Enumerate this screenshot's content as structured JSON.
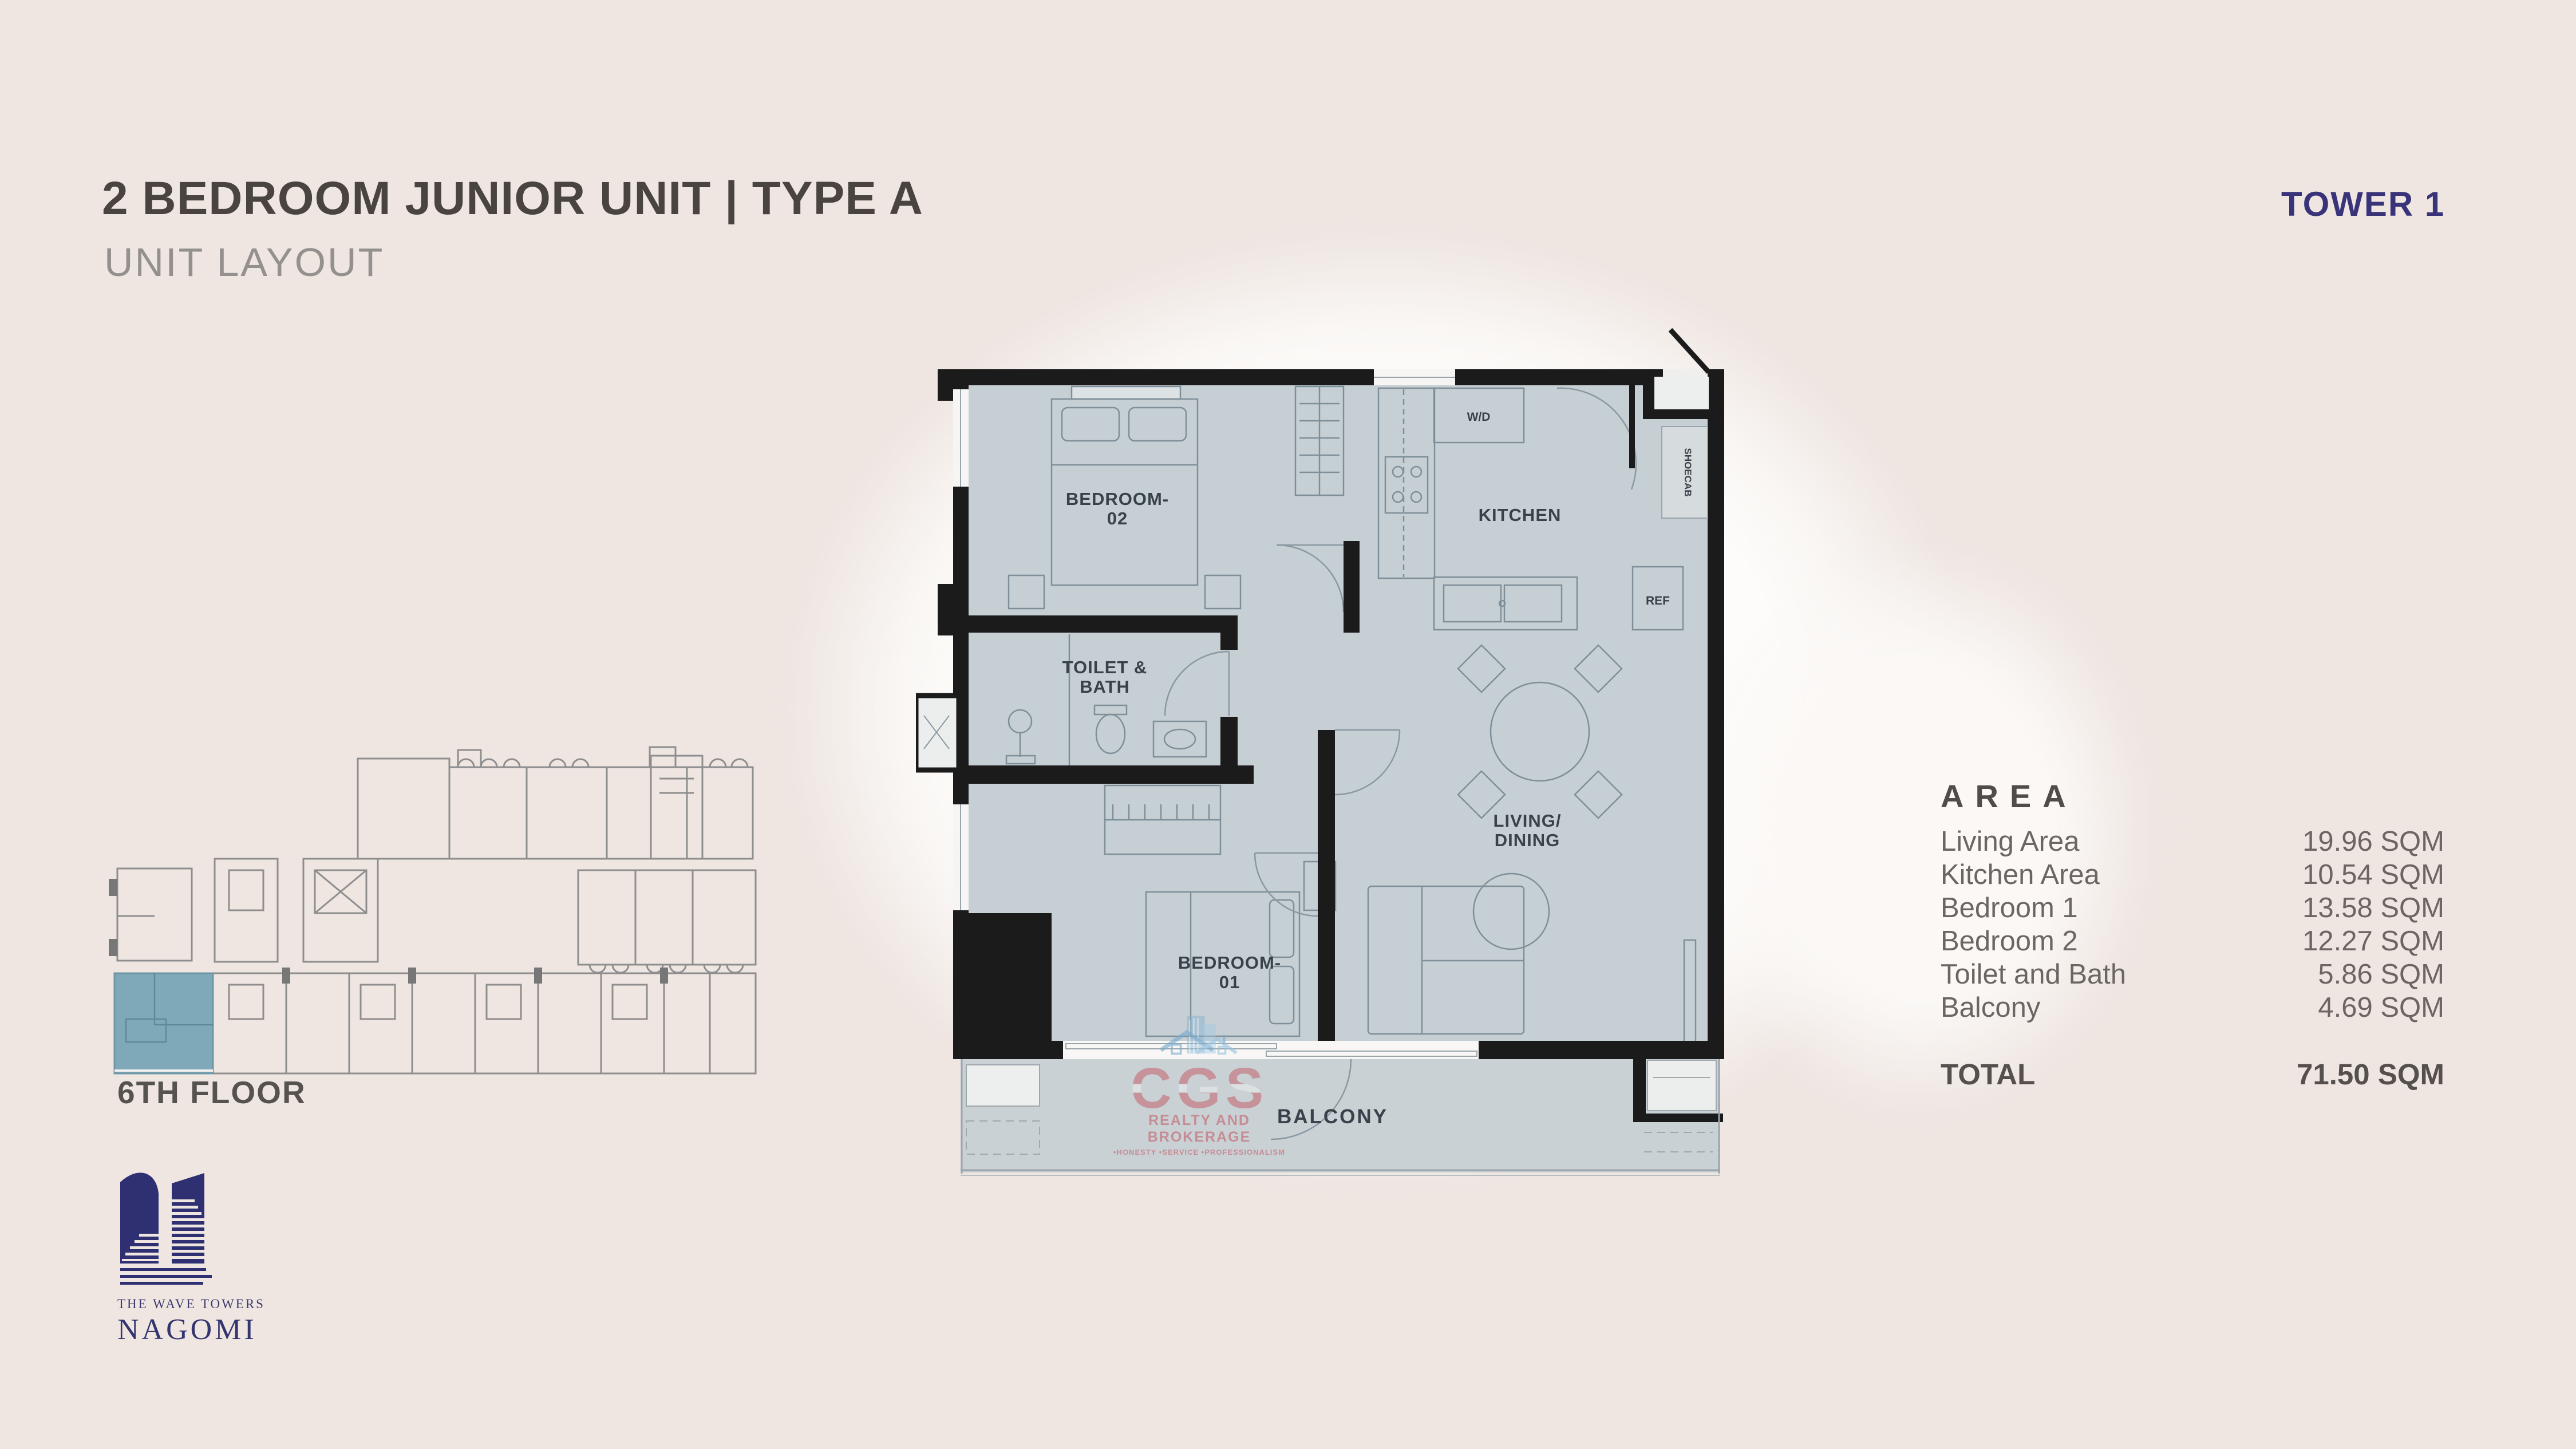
{
  "header": {
    "title": "2 BEDROOM JUNIOR UNIT | TYPE A",
    "subtitle": "UNIT LAYOUT",
    "tower": "TOWER 1"
  },
  "plan": {
    "labels": {
      "bedroom2_l1": "BEDROOM-",
      "bedroom2_l2": "02",
      "toilet_l1": "TOILET &",
      "toilet_l2": "BATH",
      "kitchen": "KITCHEN",
      "wd": "W/D",
      "shoecab": "SHOECAB",
      "ref": "REF",
      "living_l1": "LIVING/",
      "living_l2": "DINING",
      "bedroom1_l1": "BEDROOM-",
      "bedroom1_l2": "01",
      "balcony": "BALCONY"
    }
  },
  "keyplan": {
    "floor_label": "6TH FLOOR"
  },
  "area": {
    "heading": "AREA",
    "rows": [
      {
        "label": "Living Area",
        "value": "19.96 SQM"
      },
      {
        "label": "Kitchen Area",
        "value": "10.54 SQM"
      },
      {
        "label": "Bedroom 1",
        "value": "13.58 SQM"
      },
      {
        "label": "Bedroom 2",
        "value": "12.27 SQM"
      },
      {
        "label": "Toilet and Bath",
        "value": "5.86 SQM"
      },
      {
        "label": "Balcony",
        "value": "4.69 SQM"
      }
    ],
    "total_label": "TOTAL",
    "total_value": "71.50 SQM"
  },
  "logo": {
    "line1": "THE WAVE TOWERS",
    "line2": "NAGOMI"
  },
  "watermark": {
    "name": "CGS",
    "line2": "REALTY AND BROKERAGE",
    "line3": "•HONESTY      •SERVICE      •PROFESSIONALISM"
  },
  "colors": {
    "page_background": "#efe6e2",
    "navy_accent": "#39337a",
    "title_text": "#4a4440",
    "plan_floor": "#c6cfd3",
    "plan_wall": "#1b1b1b",
    "keyplan_highlight": "#7fa9b8",
    "watermark_red": "#c5404a",
    "watermark_blue": "#7fb3d3"
  }
}
